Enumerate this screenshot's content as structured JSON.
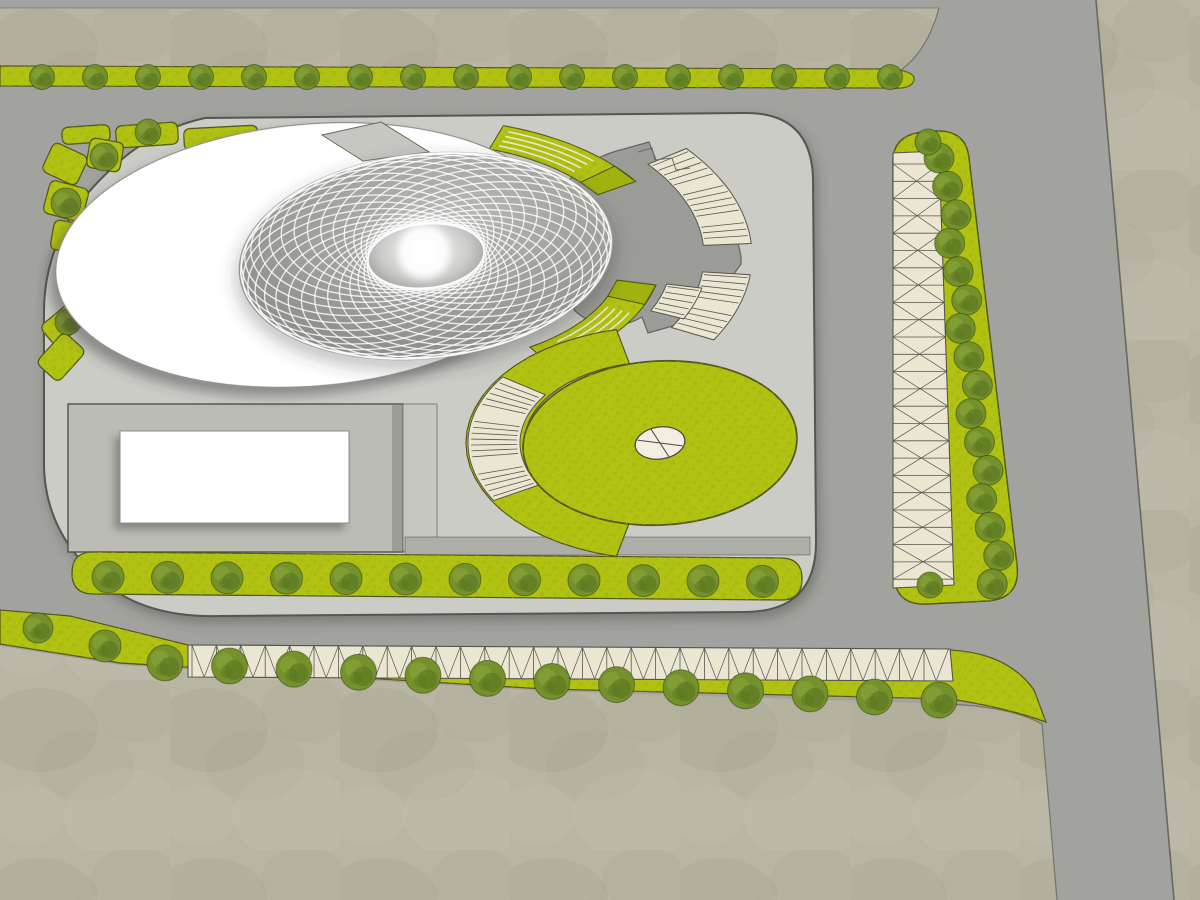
{
  "site": {
    "label": "architectural-site-master-plan",
    "view": "top-down rendered plan",
    "visible_text": []
  },
  "palette": {
    "ground": "#b8b5a3",
    "ground_dark": "#8c8872",
    "ground_light": "#cdcaba",
    "road": "#a2a39f",
    "road_edge": "#5c5d55",
    "parcel": "#cbccc6",
    "parcel_edge": "#55564f",
    "courtyard": "#bbbcb4",
    "courtyard_edge": "#51524c",
    "walkway": "#adaea7",
    "building_white": "#ffffff",
    "building_edge": "#8e8f89",
    "dome_hi": "#b6b7b3",
    "dome_mid": "#9c9d99",
    "dome_lo": "#838480",
    "lattice": "#ffffff",
    "fan": "#9b9c97",
    "fan_edge": "#63645c",
    "grass": "#b2c213",
    "grass_dark": "#9fb20f",
    "grass_edge": "#55581c",
    "tree": "#74912c",
    "tree_dark": "#5c7822",
    "tree_light": "#8daa3a",
    "cream": "#eae6d2",
    "cream_line": "#55564e",
    "shadow": "#3c3d38"
  },
  "features": {
    "parcel": {
      "shape": "rounded-rectangle"
    },
    "oval_building": {
      "shape": "white-ellipse",
      "has_shadow": true
    },
    "lattice_dome": {
      "guilloche_rings": 30,
      "bright_center": true
    },
    "amphitheater": {
      "stair_flights": 3,
      "striped_green_ramps": 2
    },
    "circular_lawn": {
      "west_stair_arc": true,
      "center_ornament": true
    },
    "courtyard": {
      "white_building": true,
      "hatch_lines": 6
    },
    "planting_beds": 9,
    "tree_counts": {
      "north_avenue": 17,
      "south_plot_strip": 12,
      "south_boulevard": 15,
      "east_parking": 18,
      "corner_bed_trees": 4
    },
    "pergolas": {
      "south_bays": 31,
      "east_rungs": 25
    }
  }
}
